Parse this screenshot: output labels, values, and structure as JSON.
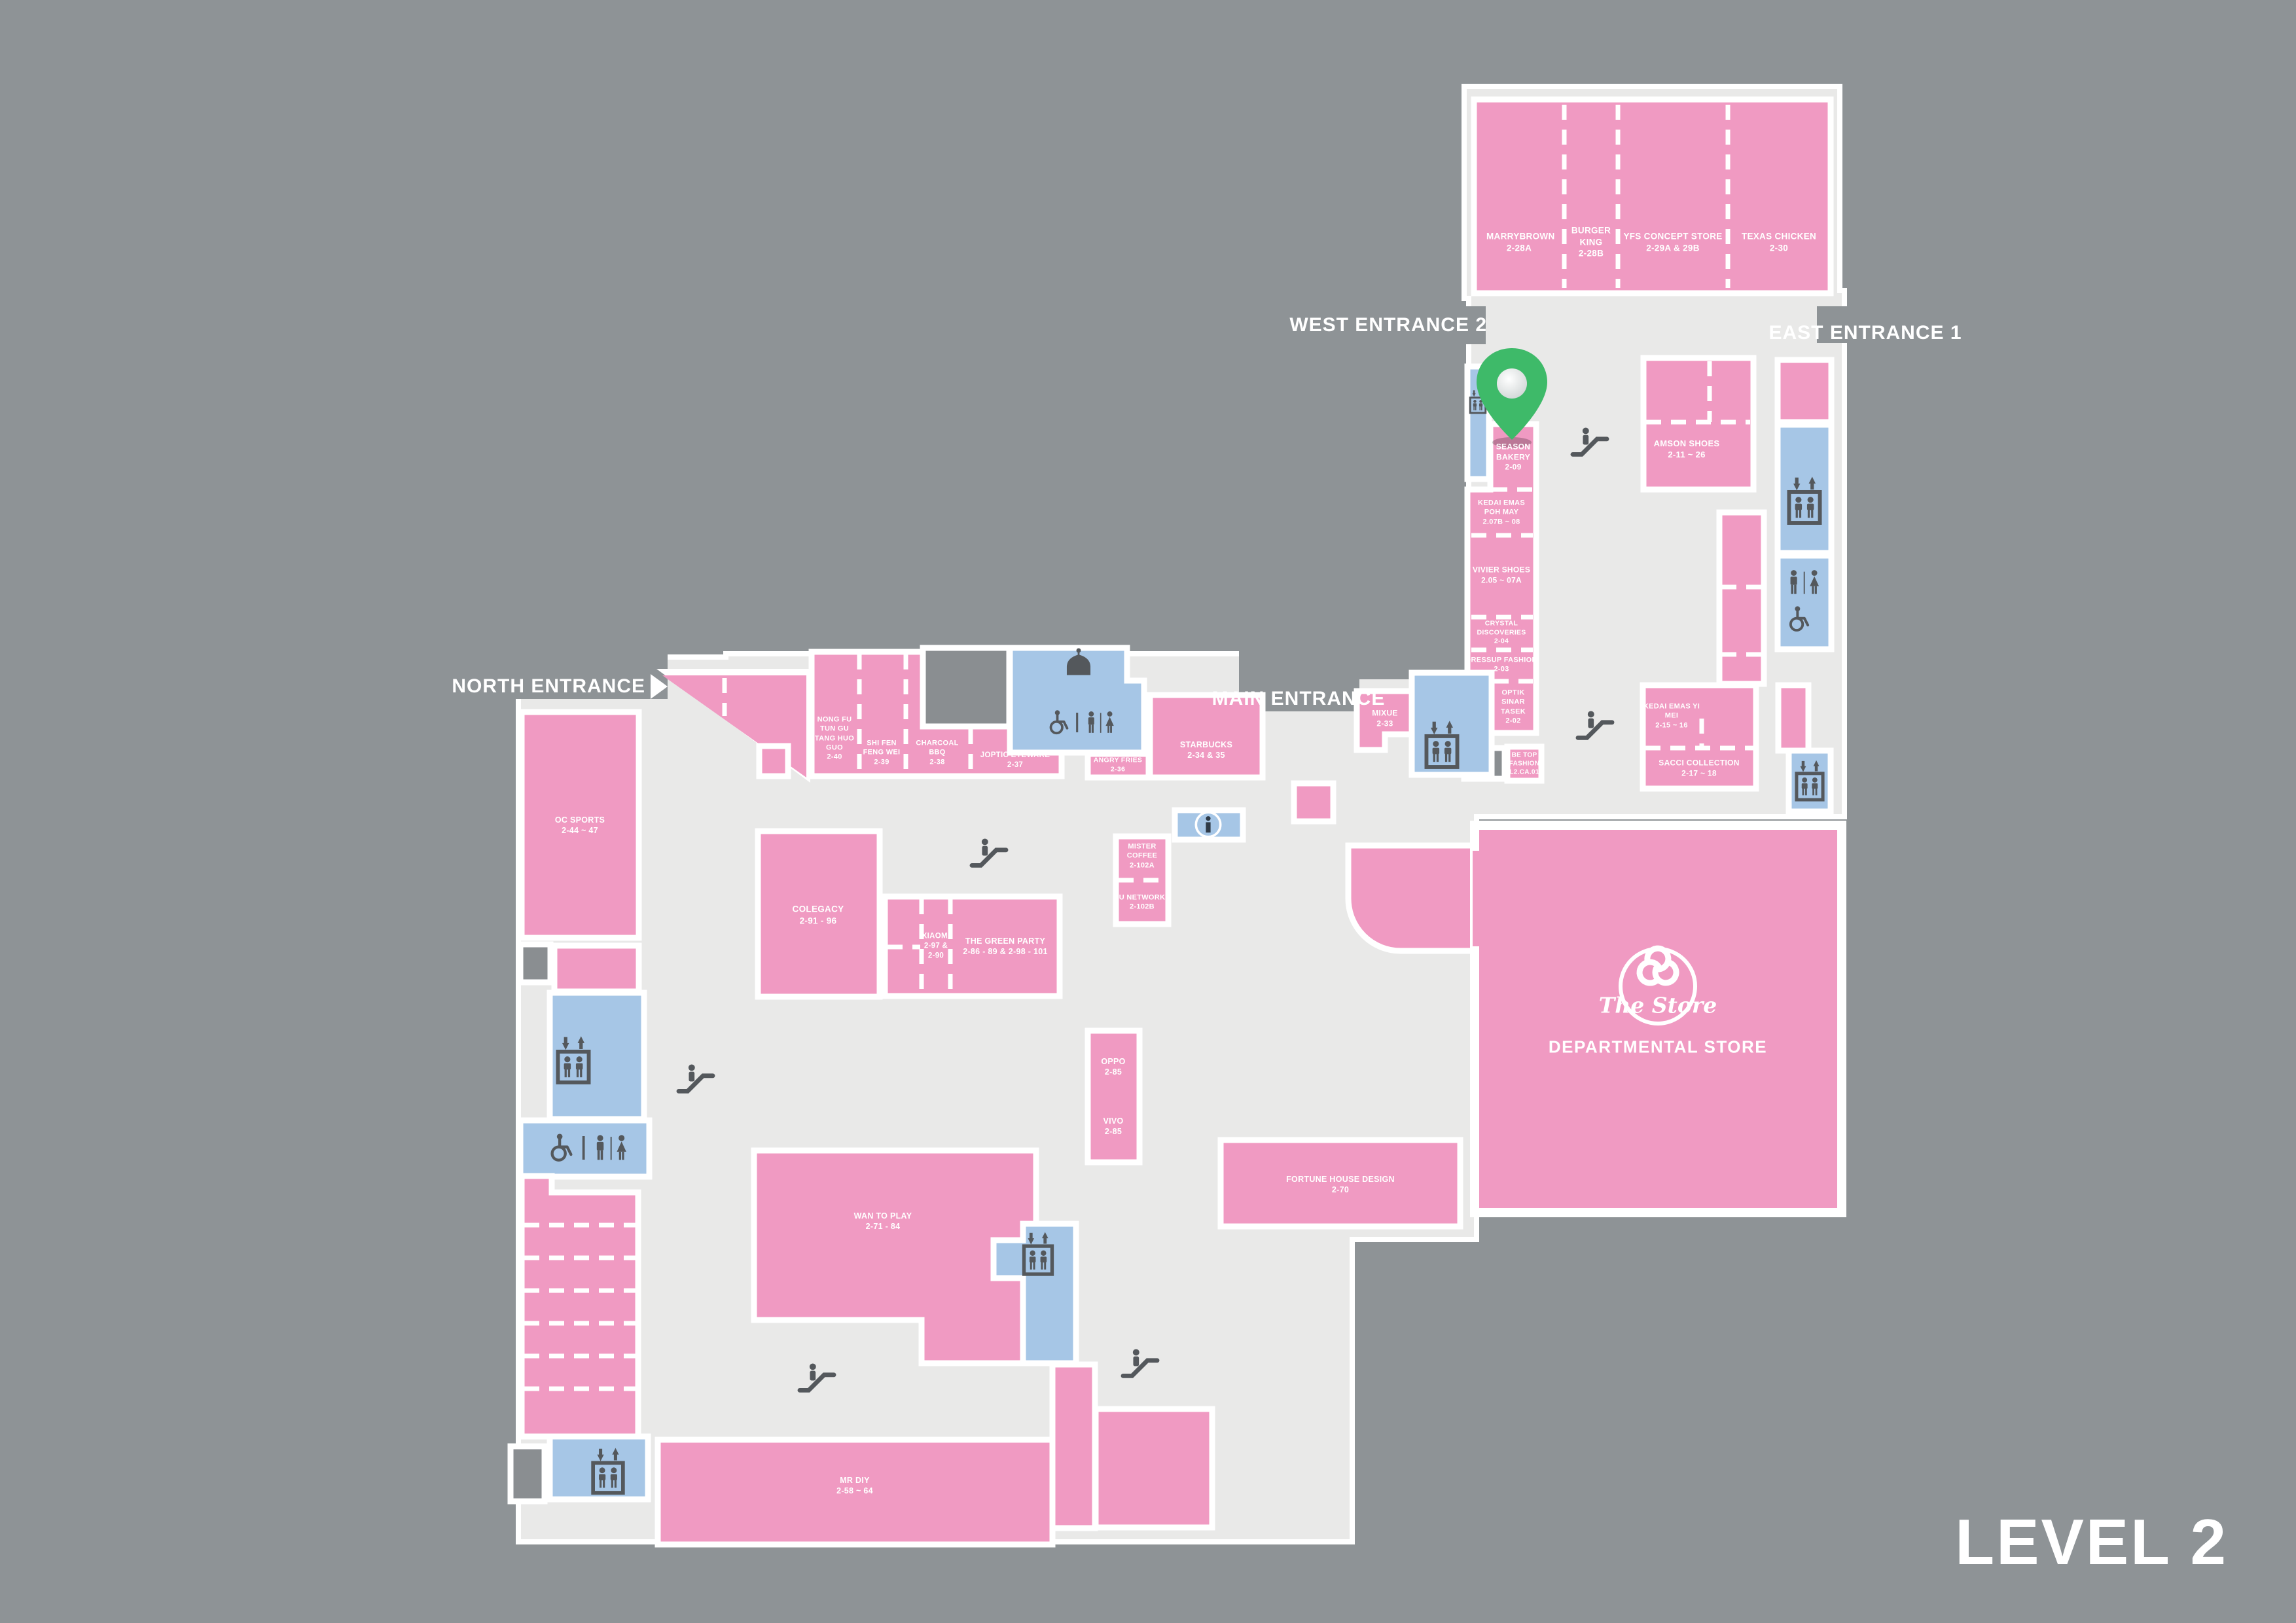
{
  "level_label": "LEVEL 2",
  "entrances": {
    "west": "WEST ENTRANCE 2",
    "east": "EAST ENTRANCE 1",
    "main": "MAIN ENTRANCE",
    "north": "NORTH ENTRANCE"
  },
  "department_store": {
    "logo": "The Store",
    "label": "DEPARTMENTAL STORE"
  },
  "stores": [
    {
      "name": "MARRYBROWN",
      "unit": "2-28A"
    },
    {
      "name": "BURGER KING",
      "unit": "2-28B"
    },
    {
      "name": "YFS CONCEPT STORE",
      "unit": "2-29A & 29B"
    },
    {
      "name": "TEXAS CHICKEN",
      "unit": "2-30"
    },
    {
      "name": "SEASON BAKERY",
      "unit": "2-09"
    },
    {
      "name": "KEDAI EMAS POH MAY",
      "unit": "2.07B ~ 08"
    },
    {
      "name": "VIVIER SHOES",
      "unit": "2.05 ~ 07A"
    },
    {
      "name": "CRYSTAL DISCOVERIES",
      "unit": "2-04"
    },
    {
      "name": "DRESSUP FASHION",
      "unit": "2-03"
    },
    {
      "name": "OPTIK SINAR TASEK",
      "unit": "2-02"
    },
    {
      "name": "BE TOP FASHION",
      "unit": "L2.CA.01"
    },
    {
      "name": "MIXUE",
      "unit": "2-33"
    },
    {
      "name": "AMSON SHOES",
      "unit": "2-11 ~ 26"
    },
    {
      "name": "KEDAI EMAS YI MEI",
      "unit": "2-15 ~ 16"
    },
    {
      "name": "SACCI COLLECTION",
      "unit": "2-17 ~ 18"
    },
    {
      "name": "NONG FU TUN GU TANG HUO GUO",
      "unit": "2-40"
    },
    {
      "name": "SHI FEN FENG WEI",
      "unit": "2-39"
    },
    {
      "name": "CHARCOAL BBQ",
      "unit": "2-38"
    },
    {
      "name": "JOPTIC EYEWARE",
      "unit": "2-37"
    },
    {
      "name": "ANGRY FRIES",
      "unit": "2-36"
    },
    {
      "name": "STARBUCKS",
      "unit": "2-34 & 35"
    },
    {
      "name": "MISTER COFFEE",
      "unit": "2-102A"
    },
    {
      "name": "U NETWORK",
      "unit": "2-102B"
    },
    {
      "name": "COLEGACY",
      "unit": "2-91 - 96"
    },
    {
      "name": "XIAOMI",
      "unit": "2-97 & 2-90"
    },
    {
      "name": "THE GREEN PARTY",
      "unit": "2-86 - 89 & 2-98 - 101"
    },
    {
      "name": "OC SPORTS",
      "unit": "2-44 ~ 47"
    },
    {
      "name": "OPPO",
      "unit": "2-85"
    },
    {
      "name": "VIVO",
      "unit": "2-85"
    },
    {
      "name": "FORTUNE HOUSE DESIGN",
      "unit": "2-70"
    },
    {
      "name": "WAN TO PLAY",
      "unit": "2-71 - 84"
    },
    {
      "name": "MR DIY",
      "unit": "2-58 ~ 64"
    }
  ],
  "facility_icons": [
    "escalator",
    "elevator",
    "male-female-restroom",
    "wheelchair-accessible",
    "prayer-room",
    "information",
    "location-pin"
  ],
  "colors": {
    "background": "#8e9396",
    "floor": "#e9e9e8",
    "store_fill": "#f09ac2",
    "facility_fill": "#a6c6e6",
    "service_fill": "#8a8e91",
    "outline": "#ffffff",
    "icon": "#54585c",
    "pin_green": "#3eba69",
    "info_glyph": "#2f3a46"
  }
}
